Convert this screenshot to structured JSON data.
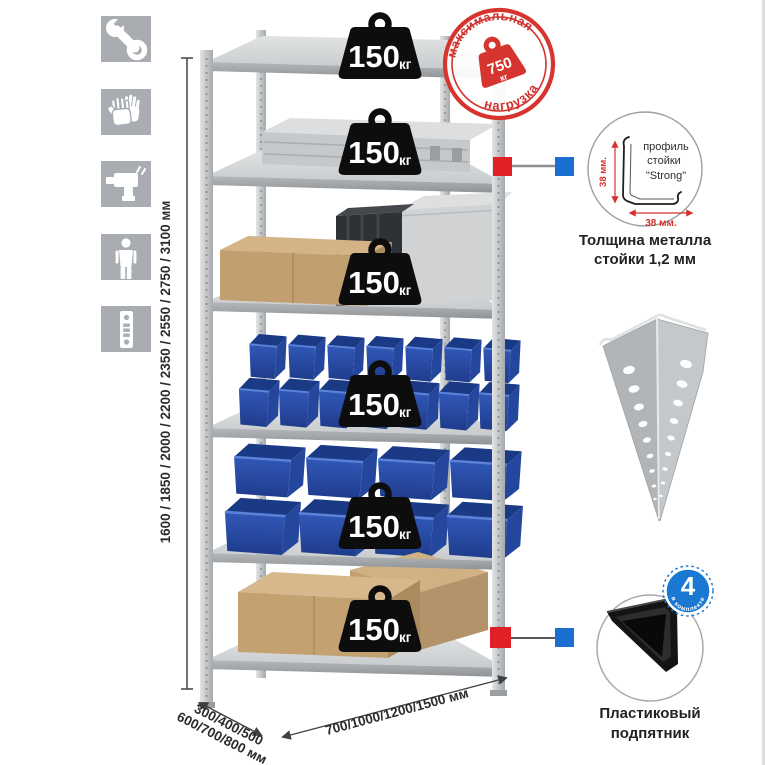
{
  "colors": {
    "accent_red": "#d6322d",
    "accent_blue": "#1b6fd0",
    "bin_blue": "#2a4fae",
    "metal_gray": "#c9cccf",
    "badge_black": "#0d0d0d",
    "icon_gray": "#a9adb2"
  },
  "icons": [
    "wrench-icon",
    "gloves-icon",
    "drill-icon",
    "person-icon",
    "perforated-strip-icon"
  ],
  "dimensions": {
    "height_text": "1600 / 1850 / 2000 / 2200 / 2350 / 2550 / 2750 / 3100 мм",
    "depth_text_line1": "300/400/500",
    "depth_text_line2": "600/700/800 мм",
    "width_text": "700/1000/1200/1500 мм"
  },
  "shelves": [
    {
      "load": "150",
      "unit": "кг"
    },
    {
      "load": "150",
      "unit": "кг"
    },
    {
      "load": "150",
      "unit": "кг"
    },
    {
      "load": "150",
      "unit": "кг"
    },
    {
      "load": "150",
      "unit": "кг"
    },
    {
      "load": "150",
      "unit": "кг"
    }
  ],
  "stamp": {
    "arc_top": "максимальная",
    "arc_bottom": "нагрузка",
    "value": "750",
    "unit": "кг"
  },
  "profile_detail": {
    "label_line1": "профиль",
    "label_line2": "стойки",
    "label_line3": "\"Strong\"",
    "dim_vertical": "38 мм.",
    "dim_horizontal": "38 мм.",
    "caption_line1": "Толщина металла",
    "caption_line2": "стойки 1,2 мм"
  },
  "foot_detail": {
    "badge_value": "4",
    "badge_label": "в комплекте",
    "caption_line1": "Пластиковый",
    "caption_line2": "подпятник"
  }
}
